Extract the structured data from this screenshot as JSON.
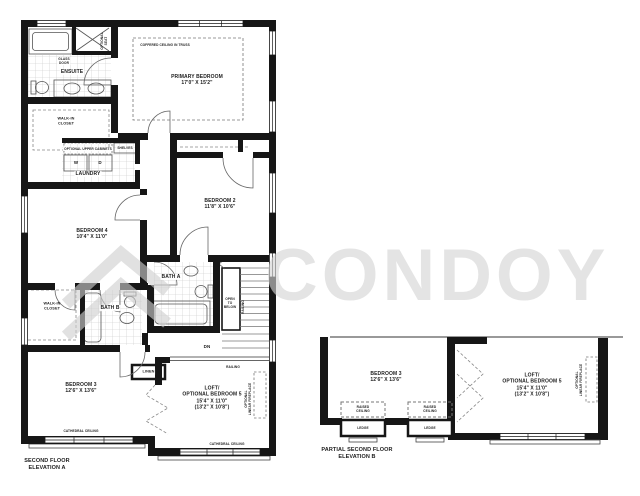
{
  "watermark": {
    "text": "CONDOY",
    "color": "#d9d9d9"
  },
  "plan_a": {
    "caption": "SECOND FLOOR\nELEVATION A",
    "primary_bedroom": {
      "label": "PRIMARY BEDROOM\n17'0\" X 15'2\"",
      "ceiling": "COFFERED CEILING IN TRUSS"
    },
    "ensuite": {
      "label": "ENSUITE",
      "glass_door": "GLASS\nDOOR",
      "optional_seat": "OPTIONAL\nSEAT"
    },
    "walk_in_closet": "WALK-IN\nCLOSET",
    "laundry": {
      "label": "LAUNDRY",
      "optional_upper_cabinets": "OPTIONAL UPPER CABINETS",
      "washer": "W",
      "dryer": "D",
      "shelves": "SHELVES"
    },
    "bedroom_2": {
      "label": "BEDROOM 2\n11'8\" X 10'6\""
    },
    "bedroom_4": {
      "label": "BEDROOM 4\n10'4\" X 11'0\""
    },
    "bath_a": {
      "label": "BATH A"
    },
    "bath_b": {
      "label": "BATH B"
    },
    "walk_in_closet_2": "WALK-IN\nCLOSET",
    "stairs": {
      "open_to_below": "OPEN\nTO\nBELOW",
      "railing_side": "RAILING",
      "railing_bottom": "RAILING",
      "down": "DN"
    },
    "linen": "LINEN",
    "bedroom_3": {
      "label": "BEDROOM 3\n12'6\" X 13'6\"",
      "ceiling": "CATHEDRAL CEILING"
    },
    "loft": {
      "label": "LOFT/\nOPTIONAL BEDROOM 5\n15'4\" X 11'0\"\n(13'2\" X 10'8\")",
      "fireplace": "OPTIONAL\nLINEAR FIREPLACE",
      "ceiling": "CATHEDRAL CEILING"
    }
  },
  "plan_b": {
    "caption": "PARTIAL SECOND FLOOR\nELEVATION B",
    "bedroom_3": {
      "label": "BEDROOM 3\n12'6\" X 13'6\""
    },
    "loft": {
      "label": "LOFT/\nOPTIONAL BEDROOM 5\n15'4\" X 11'0\"\n(13'2\" X 10'8\")",
      "fireplace": "OPTIONAL\nLINEAR FIREPLACE"
    },
    "raised_ceiling": "RAISED\nCEILING",
    "ledge": "LEDGE"
  }
}
